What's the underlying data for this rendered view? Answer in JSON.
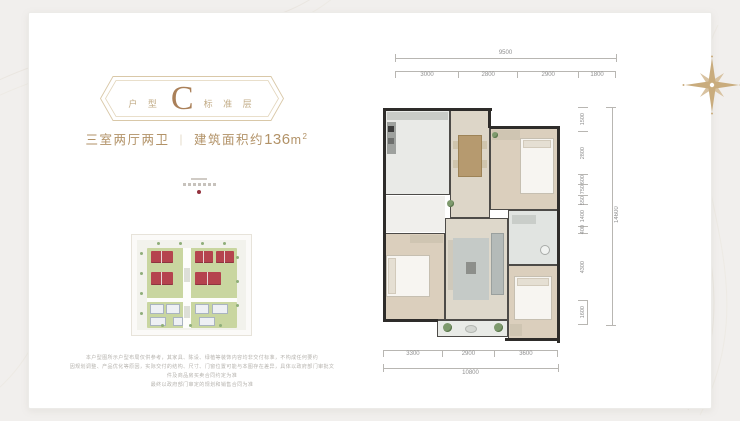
{
  "page": {
    "bg": "#f1efed",
    "card_bg": "#ffffff",
    "accent_gold": "#b29267"
  },
  "badge": {
    "label_left": "户 型",
    "letter": "C",
    "label_right": "标 准 层",
    "border_color": "#d9c8a8",
    "letter_color": "#aa8059"
  },
  "title": {
    "rooms": "三室两厅两卫",
    "divider": "｜",
    "area_prefix": "建筑面积约",
    "area_value": "136",
    "area_unit_base": "m",
    "area_unit_sup": "2"
  },
  "brand_mark": {
    "dot_color": "#93323e"
  },
  "site_map": {
    "red_roof_color": "#b5434e",
    "lawn_color": "#c9d6a0",
    "white_building_color": "#eef0f4"
  },
  "disclaimer": {
    "lines": [
      "本户型图所示户型布局仅供参考，其家具、陈设、绿植等装饰内容均非交付标准，不构成任何要约",
      "因规划调整、产品优化等原因，实际交付的结构、尺寸、门窗位置可能与本图存在差异，具体以政府部门审批文件及商品房买卖合同约定为准",
      "最终以政府部门审定的规划和销售合同为准"
    ]
  },
  "floor_plan": {
    "dims_top": {
      "total": "9500",
      "segments": [
        "3000",
        "2800",
        "2900",
        "1800"
      ]
    },
    "dims_right": {
      "total": "14600",
      "segments": [
        "1500",
        "2800",
        "600",
        "750",
        "550",
        "1400",
        "400",
        "4300",
        "1600"
      ]
    },
    "dims_bottom": {
      "total": "10800",
      "segments": [
        "3300",
        "2900",
        "3600"
      ]
    },
    "wall_color": "#2e2c2a"
  },
  "compass": {
    "color": "#c9ac7d"
  }
}
